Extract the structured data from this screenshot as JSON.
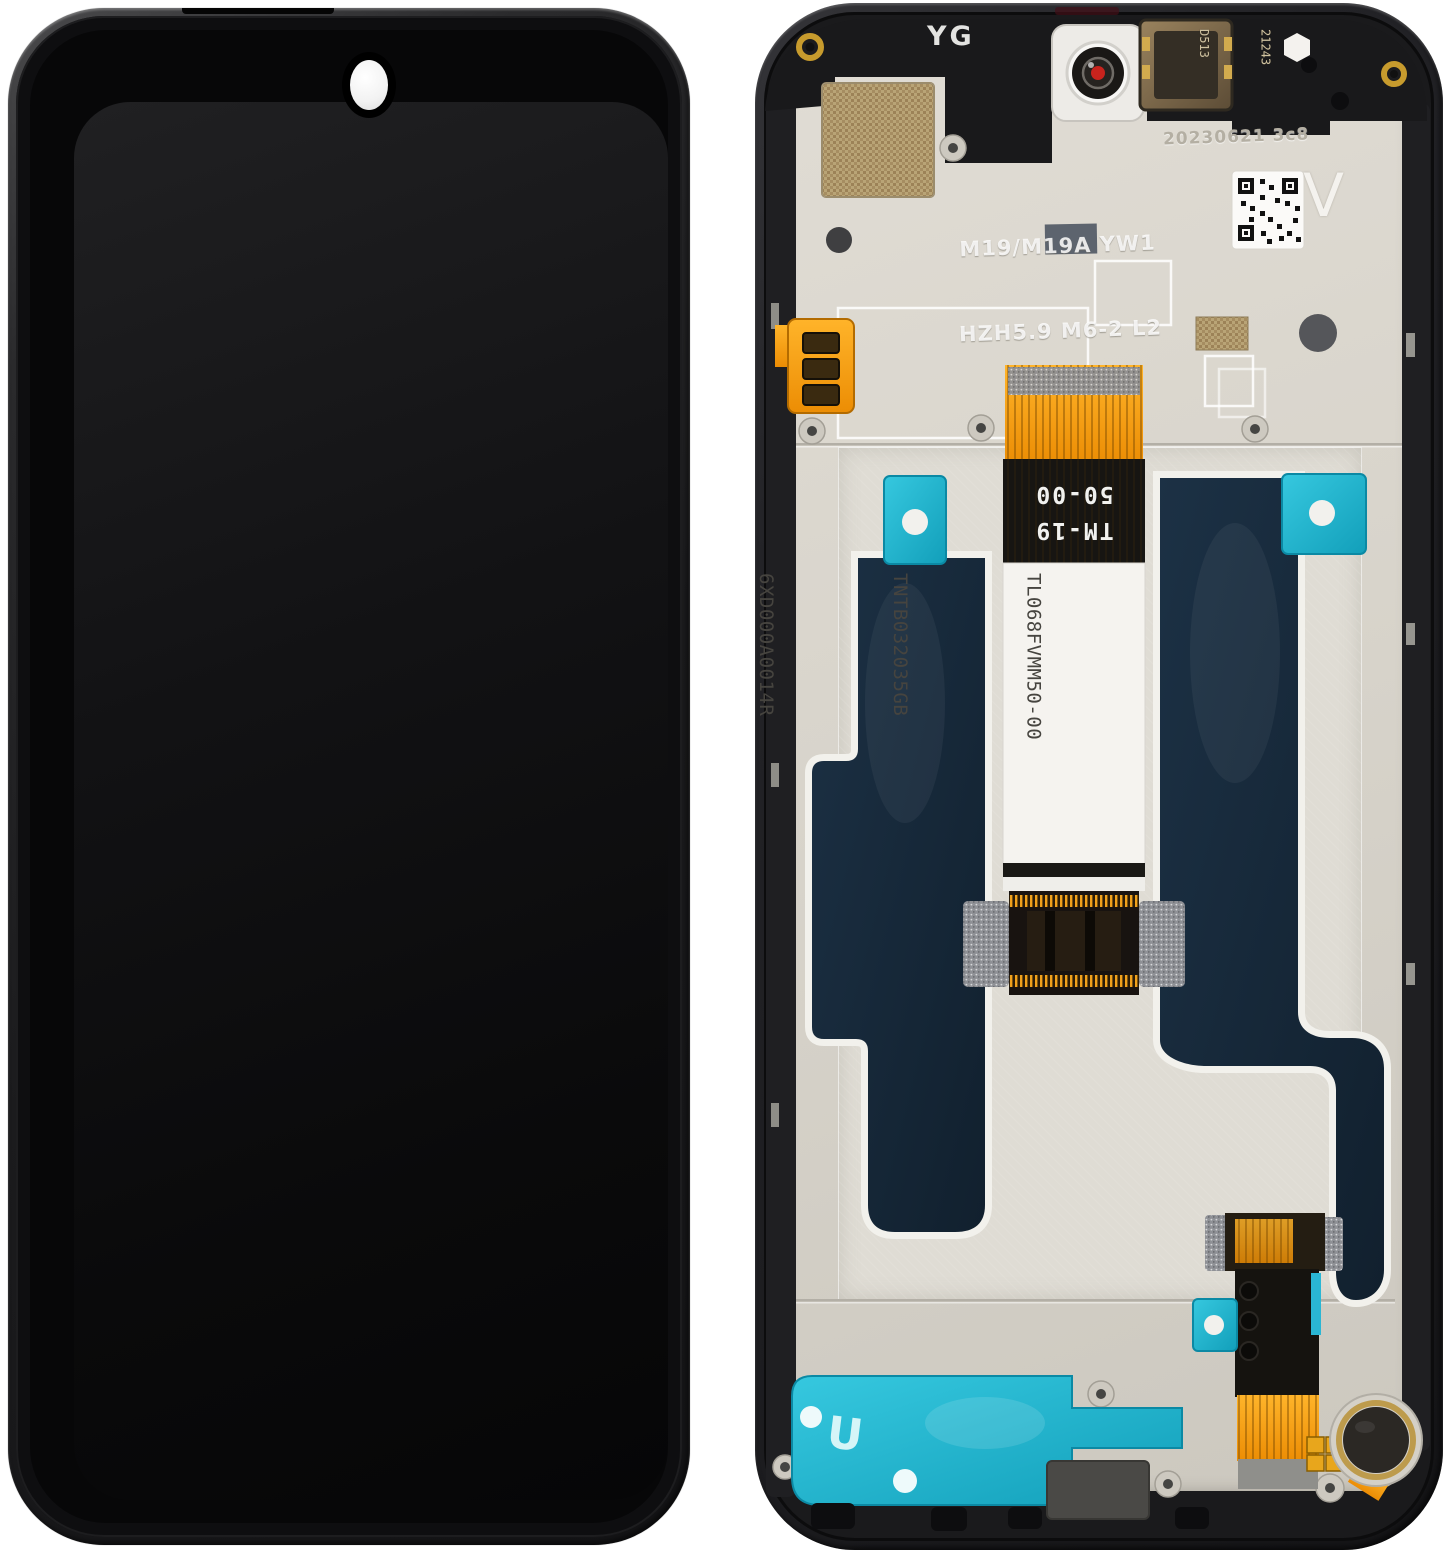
{
  "colors": {
    "background": "#ffffff",
    "frame_black": "#1e1e20",
    "plate_beige": "#d8d4cb",
    "adhesive_navy": "#16293a",
    "adhesive_teal": "#1cb4cf",
    "flex_orange": "#f09a10",
    "mesh_gold": "#b2996c",
    "camera_dot_red": "#c4221e",
    "label_white": "#f5f3ef"
  },
  "back_view": {
    "top_markings": {
      "frame_code": "YG",
      "speaker_code_lines": [
        "D513",
        "21243"
      ],
      "date_stamp": "20230621 3c8",
      "etch_lines": [
        "M19/M19A YW1",
        "HZH5.9 M6-2 L2"
      ],
      "qr_side_letter": "V"
    },
    "main_flex": {
      "print_lines": [
        "TM-19",
        "50-00"
      ],
      "label_lines": [
        "TL068FVMM50-00",
        "TNTB032035GB",
        "6XD000A0014R"
      ]
    },
    "speaker_adhesive_glyph": "U"
  }
}
